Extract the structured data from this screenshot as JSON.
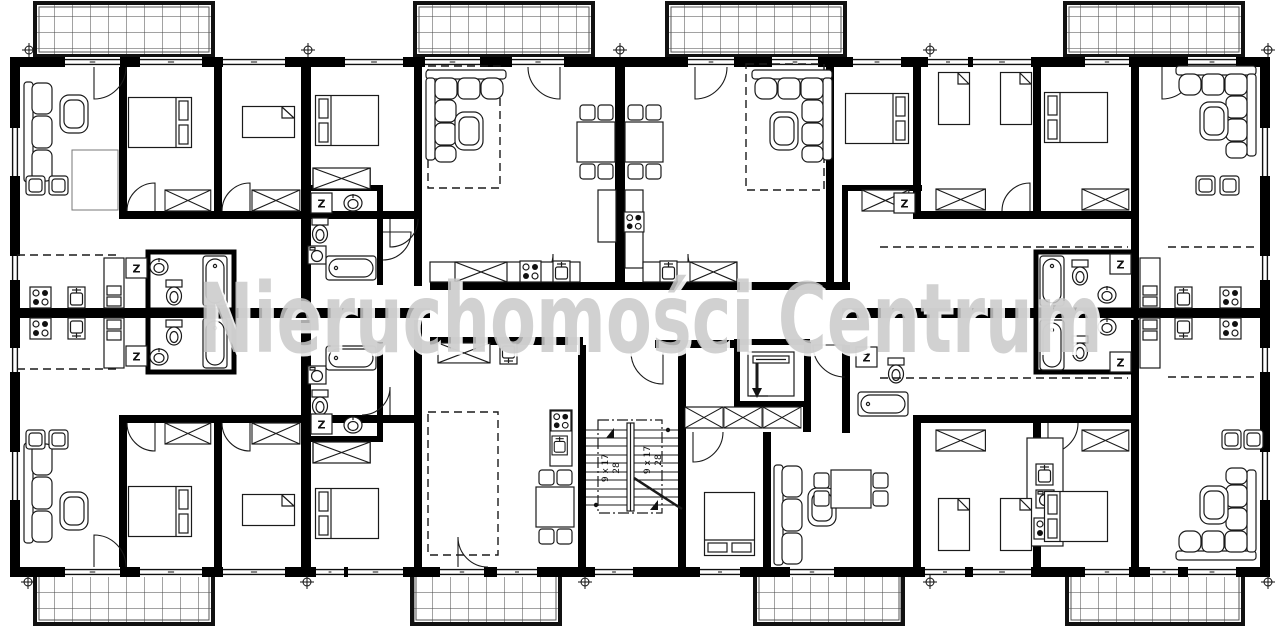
{
  "watermark": {
    "text": "Nieruchomości Centrum",
    "color": "#c9c9c9"
  },
  "stairs": {
    "rise_label": "9 x 17",
    "tread_label": "28"
  },
  "room_labels": {
    "utility": "Z"
  },
  "style": {
    "wall_color": "#000000",
    "background": "#ffffff",
    "line_color": "#1a1a1a",
    "watermark_color": "#c9c9c9"
  }
}
